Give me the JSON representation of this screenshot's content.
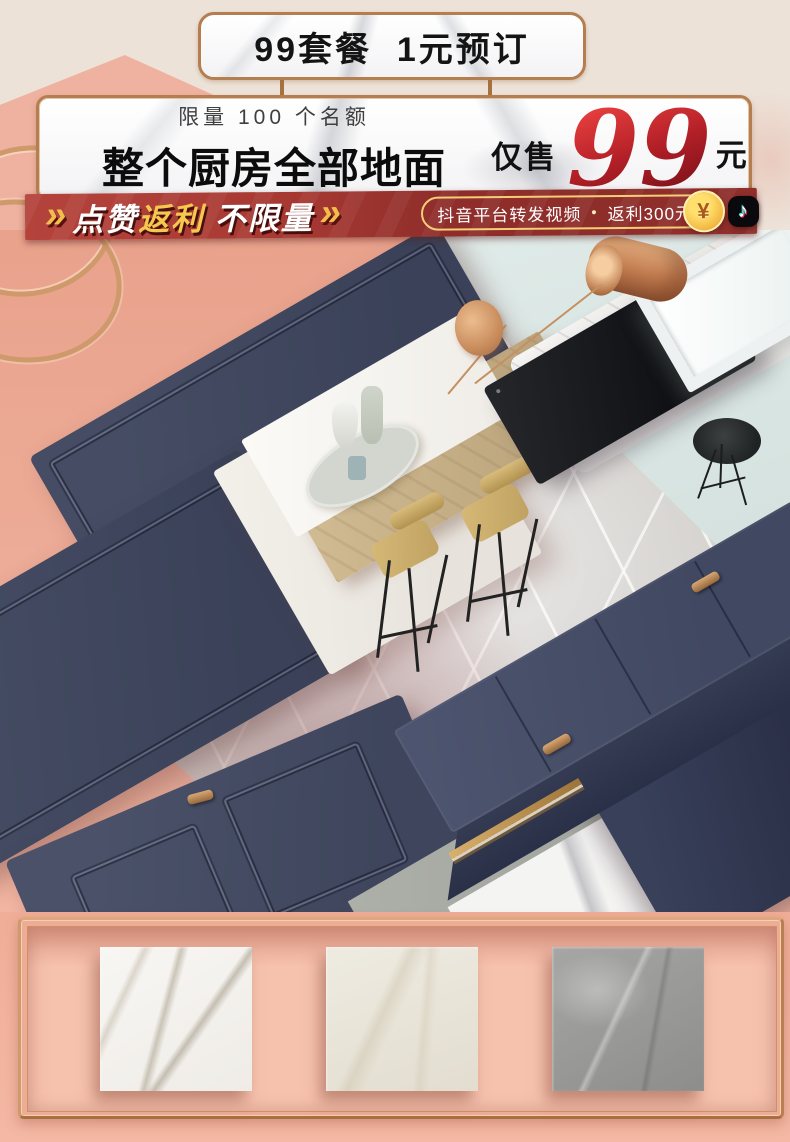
{
  "top_badge": {
    "label": "99套餐  1元预订"
  },
  "offer_banner": {
    "limit_note": "限量 100 个名额",
    "headline": "整个厨房全部地面",
    "price_prefix": "仅售",
    "price": "99",
    "price_unit": "元"
  },
  "rebate_ribbon": {
    "chevrons_left": "»",
    "like_text": "点赞",
    "rebate_text": "返利",
    "unlimited_text": " 不限量",
    "chevrons_right": "»",
    "pill": {
      "platform_text": "抖音平台转发视频",
      "bullet": "•",
      "rebate_amount": "返利300元"
    },
    "coin_symbol": "¥",
    "tiktok_glyph": "♪"
  },
  "scene": {
    "objects": [
      "navy-cabinet-door-panels",
      "grey-marble-tile-floor",
      "kitchen-island-with-wood-counter",
      "bar-stools",
      "white-sofa-black-back-panel",
      "copper-pendant-lamp",
      "skylight-window",
      "navy-drawer-console",
      "white-marble-slab"
    ]
  },
  "tile_samples": [
    {
      "name": "white-marble-tile"
    },
    {
      "name": "cream-marble-tile"
    },
    {
      "name": "grey-marble-tile"
    }
  ],
  "colors": {
    "copper": "#b57e50",
    "ribbon_red": "#a63832",
    "gold": "#f5c84e",
    "price_red": "#b01e26",
    "navy": "#3f4660",
    "blush_pink": "#efb2a0",
    "teal": "#dce8e5",
    "cream": "#ece2d8"
  }
}
